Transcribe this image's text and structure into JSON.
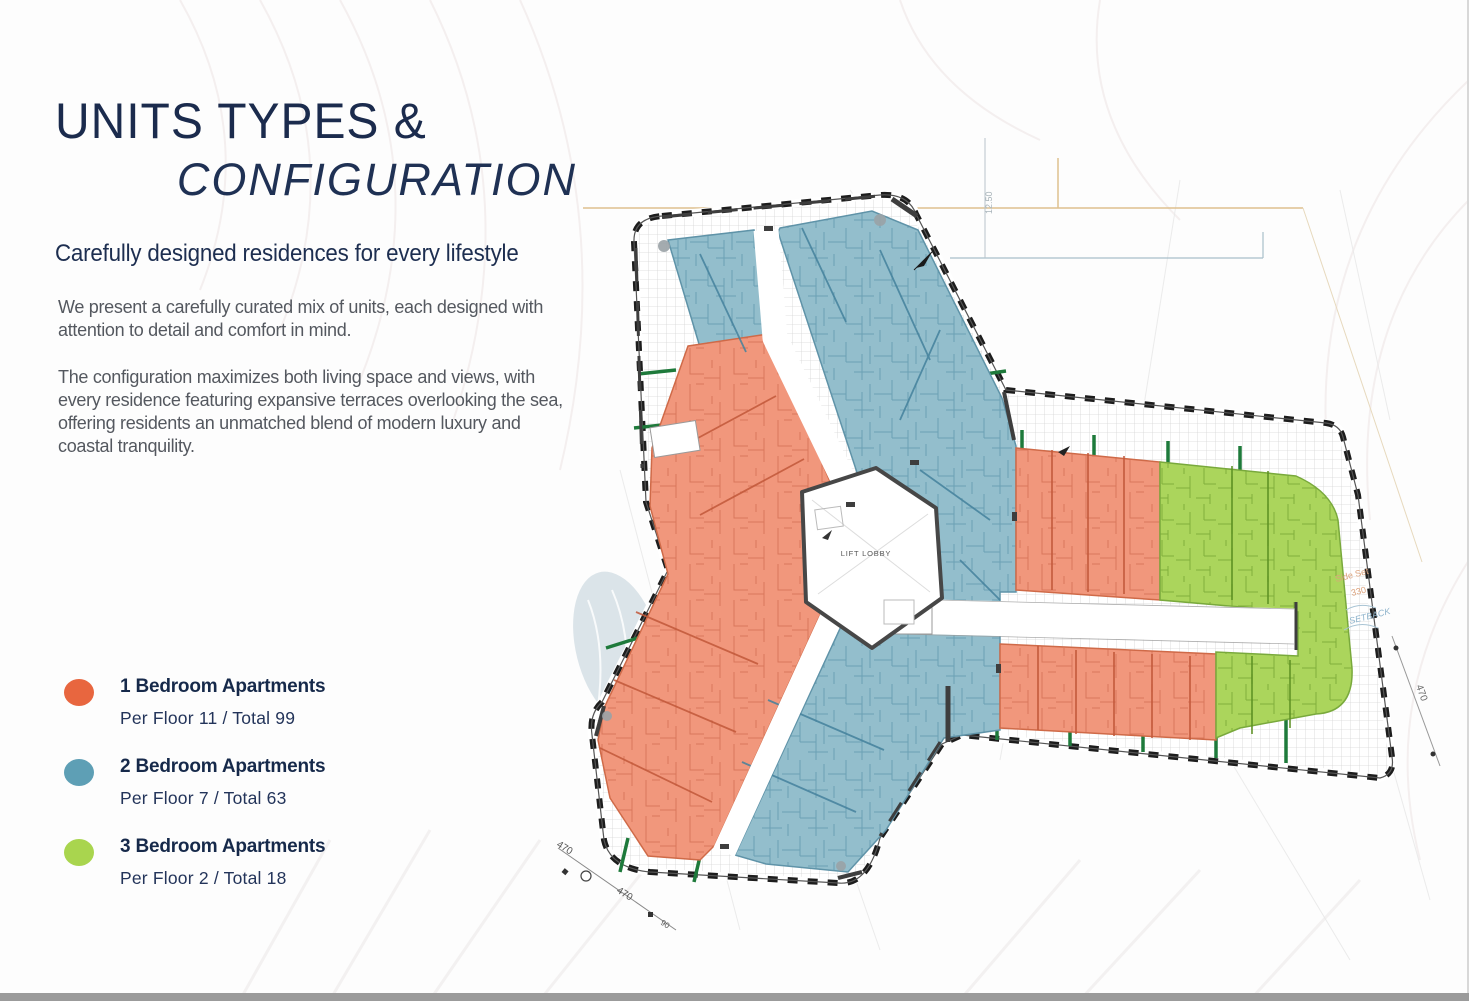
{
  "panel": {
    "title_line1": "UNITS TYPES &",
    "title_line2": "CONFIGURATION",
    "subtitle": "Carefully designed residences  for every lifestyle",
    "paragraph1": "We present a carefully curated mix of units, each designed with attention to detail and comfort in mind.",
    "paragraph2": "The configuration maximizes both living space and views, with every residence featuring expansive terraces overlooking the sea, offering residents an unmatched blend of modern luxury and coastal tranquility.",
    "legend": [
      {
        "label": "1 Bedroom Apartments",
        "stats": "Per Floor 11 / Total 99",
        "color": "#E8663F"
      },
      {
        "label": "2 Bedroom Apartments",
        "stats": "Per Floor 7 / Total 63",
        "color": "#5E9FB5"
      },
      {
        "label": "3 Bedroom Apartments",
        "stats": "Per Floor 2 / Total 18",
        "color": "#A9D54E"
      }
    ]
  },
  "plan": {
    "lobby_label": "LIFT LOBBY",
    "annotations": {
      "setback": "SETBACK",
      "side_set_line1": "Side Set",
      "side_set_line2": "330",
      "level": "12.50",
      "dim_a": "470",
      "dim_b": "470",
      "dim_c": "470",
      "dim_small": "90"
    },
    "colors": {
      "one_bedroom_fill": "#F1977C",
      "two_bedroom_fill": "#93BECC",
      "three_bedroom_fill": "#ABD55C",
      "terrace_grid": "#D6D6D6",
      "site_boundary": "#1D1D1D",
      "facade_tick": "#1E7A3B"
    }
  }
}
